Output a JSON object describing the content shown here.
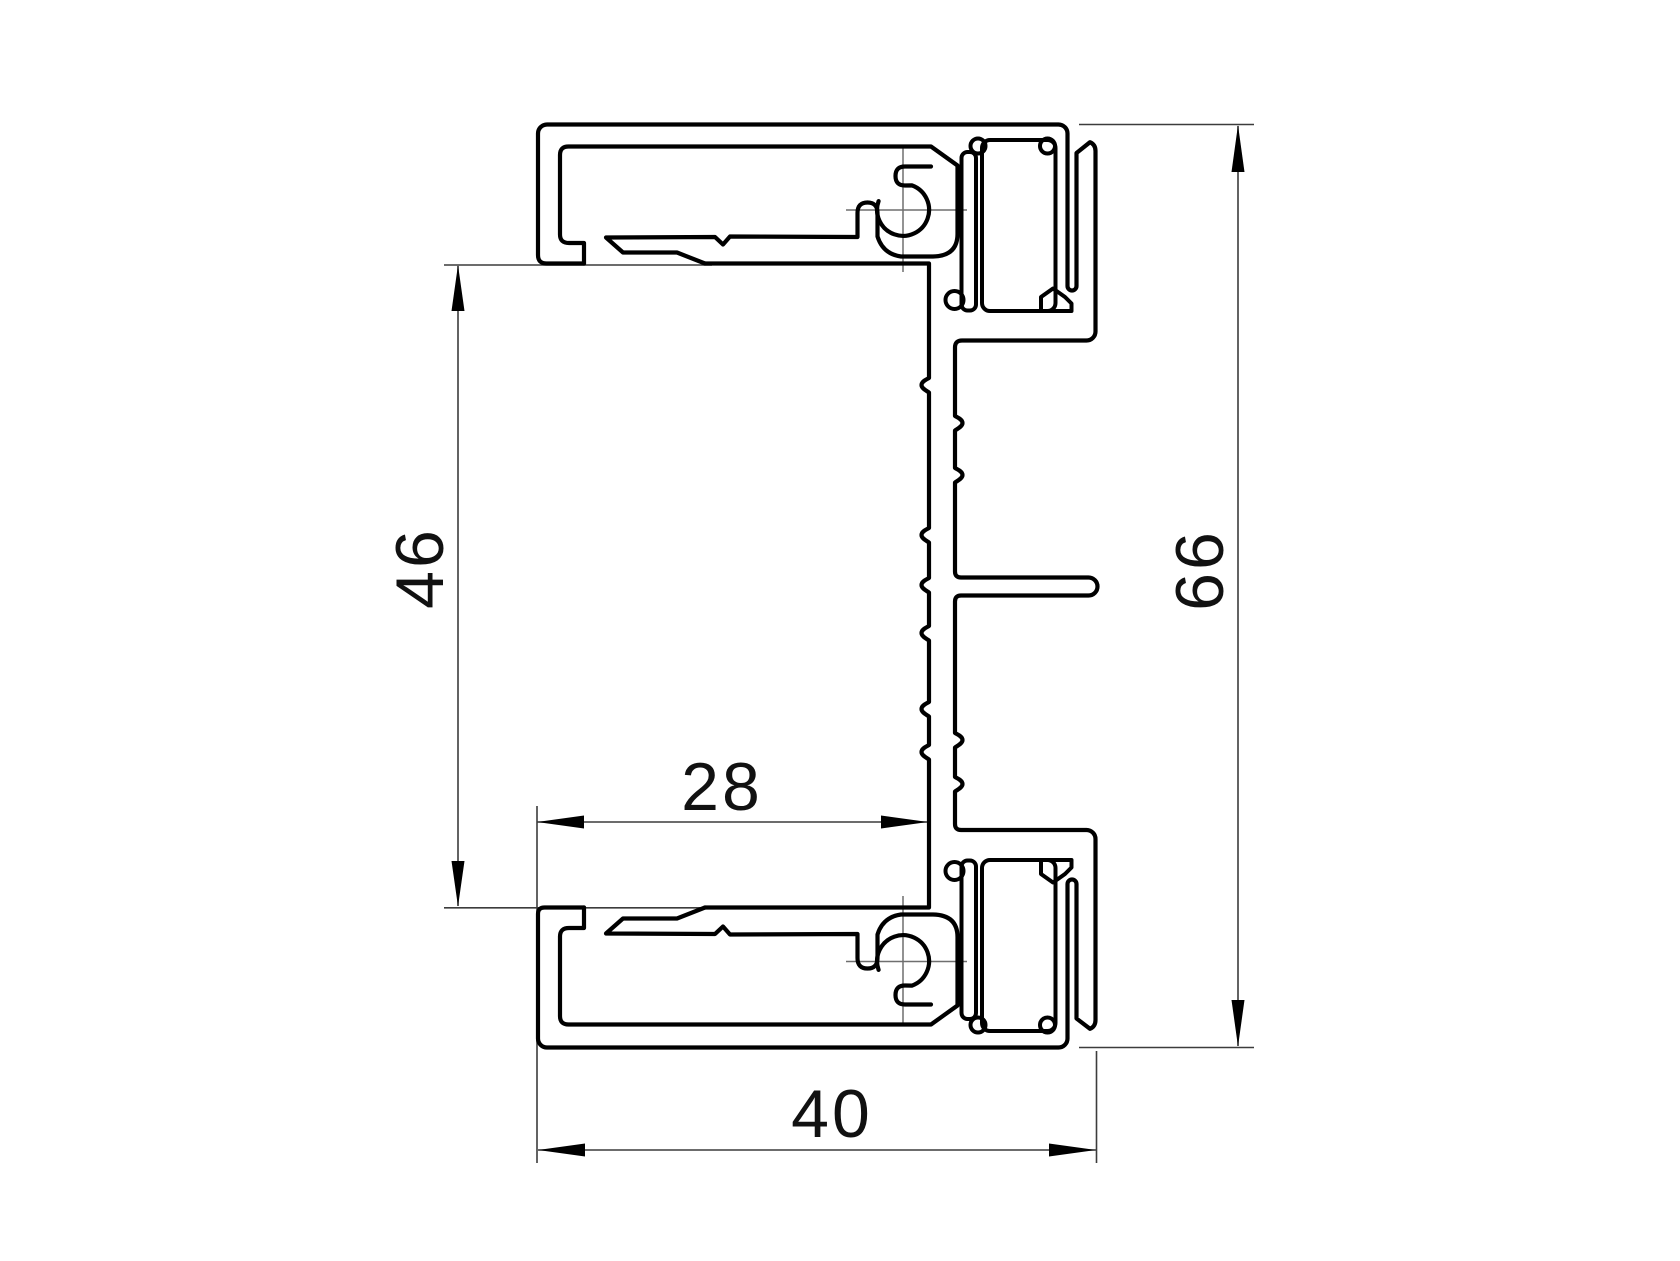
{
  "drawing": {
    "title": "aluminium-profile-cross-section",
    "background_color": "#ffffff",
    "profile_line_color": "#000000",
    "dimension_line_color": "#3c3c3c",
    "centerline_color": "#6f6f6f",
    "dimensions": {
      "inner_opening_height": {
        "value": "46",
        "orientation": "vertical-left"
      },
      "overall_height": {
        "value": "66",
        "orientation": "vertical-right"
      },
      "inner_opening_width": {
        "value": "28",
        "orientation": "horizontal-middle"
      },
      "overall_width": {
        "value": "40",
        "orientation": "horizontal-bottom"
      }
    }
  }
}
